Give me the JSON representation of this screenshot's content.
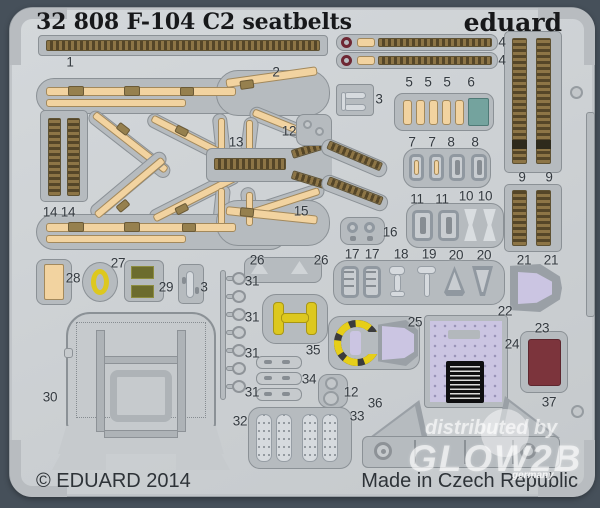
{
  "header": {
    "title": "32 808 F-104 C2 seatbelts",
    "brand": "eduard"
  },
  "footer": {
    "copyright": "© EDUARD 2014",
    "made_in": "Made in Czech Republic"
  },
  "watermark": {
    "line1": "distributed by",
    "line2": "GLOW2B",
    "line3": "germany"
  },
  "colors": {
    "background": "#46505a",
    "sheet": "#cdd1d4",
    "plate": "#b6bbbf",
    "belt_tan": "#f2d3a0",
    "belt_texture": "#8d7546",
    "teal": "#74a39e",
    "yellow": "#ddc81f",
    "olive": "#6c6c2e",
    "lavender": "#cbc5e2",
    "dark_red": "#7c343c",
    "loop_maroon": "#6e2733"
  },
  "part_labels": [
    {
      "t": "1",
      "x": 70,
      "y": 62
    },
    {
      "t": "2",
      "x": 276,
      "y": 72
    },
    {
      "t": "3",
      "x": 379,
      "y": 99
    },
    {
      "t": "4",
      "x": 502,
      "y": 42
    },
    {
      "t": "4",
      "x": 502,
      "y": 60
    },
    {
      "t": "5",
      "x": 409,
      "y": 82
    },
    {
      "t": "5",
      "x": 428,
      "y": 82
    },
    {
      "t": "5",
      "x": 447,
      "y": 82
    },
    {
      "t": "6",
      "x": 471,
      "y": 82
    },
    {
      "t": "7",
      "x": 412,
      "y": 142
    },
    {
      "t": "7",
      "x": 432,
      "y": 142
    },
    {
      "t": "8",
      "x": 451,
      "y": 142
    },
    {
      "t": "8",
      "x": 475,
      "y": 142
    },
    {
      "t": "9",
      "x": 522,
      "y": 177
    },
    {
      "t": "9",
      "x": 549,
      "y": 177
    },
    {
      "t": "10",
      "x": 466,
      "y": 196
    },
    {
      "t": "10",
      "x": 485,
      "y": 196
    },
    {
      "t": "11",
      "x": 417,
      "y": 199
    },
    {
      "t": "11",
      "x": 442,
      "y": 199
    },
    {
      "t": "12",
      "x": 289,
      "y": 131
    },
    {
      "t": "12",
      "x": 351,
      "y": 392
    },
    {
      "t": "13",
      "x": 236,
      "y": 142
    },
    {
      "t": "14",
      "x": 50,
      "y": 212
    },
    {
      "t": "14",
      "x": 68,
      "y": 212
    },
    {
      "t": "15",
      "x": 301,
      "y": 211
    },
    {
      "t": "16",
      "x": 390,
      "y": 232
    },
    {
      "t": "17",
      "x": 352,
      "y": 254
    },
    {
      "t": "17",
      "x": 372,
      "y": 254
    },
    {
      "t": "18",
      "x": 401,
      "y": 254
    },
    {
      "t": "19",
      "x": 429,
      "y": 254
    },
    {
      "t": "20",
      "x": 456,
      "y": 255
    },
    {
      "t": "20",
      "x": 484,
      "y": 255
    },
    {
      "t": "21",
      "x": 524,
      "y": 260
    },
    {
      "t": "21",
      "x": 551,
      "y": 260
    },
    {
      "t": "22",
      "x": 505,
      "y": 311
    },
    {
      "t": "23",
      "x": 542,
      "y": 328
    },
    {
      "t": "24",
      "x": 512,
      "y": 344
    },
    {
      "t": "25",
      "x": 415,
      "y": 322
    },
    {
      "t": "26",
      "x": 257,
      "y": 260
    },
    {
      "t": "26",
      "x": 321,
      "y": 260
    },
    {
      "t": "27",
      "x": 118,
      "y": 263
    },
    {
      "t": "28",
      "x": 73,
      "y": 278
    },
    {
      "t": "29",
      "x": 166,
      "y": 287
    },
    {
      "t": "3",
      "x": 204,
      "y": 287
    },
    {
      "t": "30",
      "x": 50,
      "y": 397
    },
    {
      "t": "31",
      "x": 252,
      "y": 281
    },
    {
      "t": "31",
      "x": 252,
      "y": 317
    },
    {
      "t": "31",
      "x": 252,
      "y": 353
    },
    {
      "t": "31",
      "x": 252,
      "y": 392
    },
    {
      "t": "32",
      "x": 240,
      "y": 421
    },
    {
      "t": "33",
      "x": 357,
      "y": 416
    },
    {
      "t": "34",
      "x": 309,
      "y": 379
    },
    {
      "t": "35",
      "x": 313,
      "y": 350
    },
    {
      "t": "36",
      "x": 375,
      "y": 403
    },
    {
      "t": "37",
      "x": 549,
      "y": 402
    }
  ]
}
